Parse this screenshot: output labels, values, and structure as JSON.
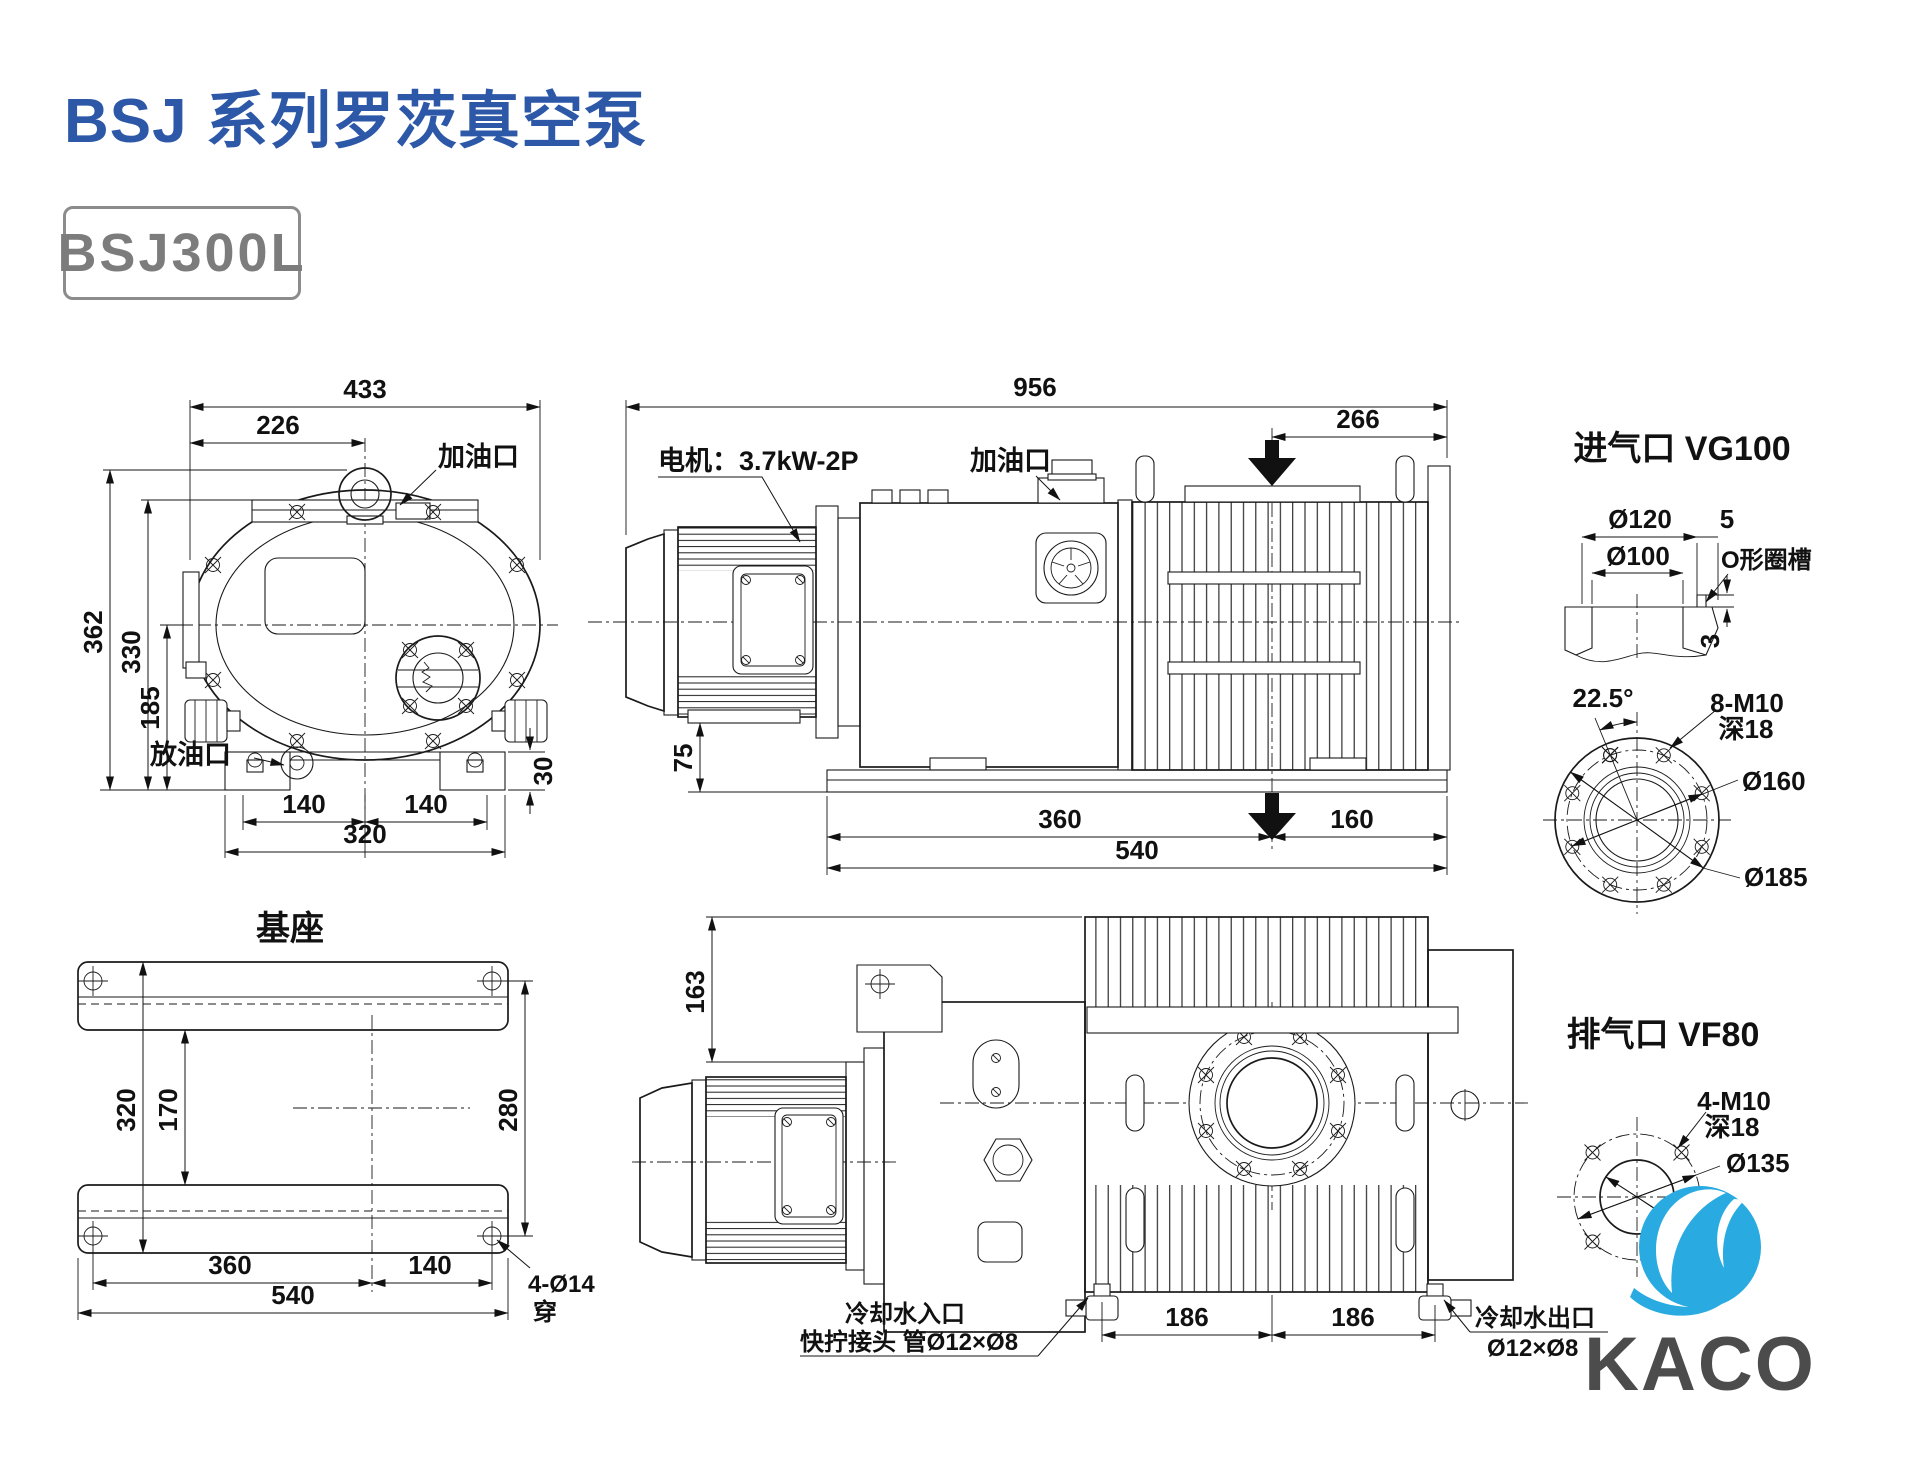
{
  "header": {
    "title": "BSJ 系列罗茨真空泵",
    "model": "BSJ300L"
  },
  "front_view": {
    "oil_fill_label": "加油口",
    "oil_drain_label": "放油口",
    "dim_433": "433",
    "dim_226": "226",
    "dim_362": "362",
    "dim_330": "330",
    "dim_185": "185",
    "dim_140l": "140",
    "dim_140r": "140",
    "dim_320": "320",
    "dim_30": "30"
  },
  "side_view": {
    "motor_label": "电机：3.7kW-2P",
    "oil_fill_label": "加油口",
    "dim_956": "956",
    "dim_266": "266",
    "dim_75": "75",
    "dim_360": "360",
    "dim_160": "160",
    "dim_540": "540"
  },
  "base_view": {
    "title": "基座",
    "dim_320": "320",
    "dim_170": "170",
    "dim_280": "280",
    "dim_360": "360",
    "dim_140": "140",
    "dim_540": "540",
    "hole_note_1": "4-Ø14",
    "hole_note_2": "穿"
  },
  "top_view": {
    "dim_163": "163",
    "dim_186l": "186",
    "dim_186r": "186",
    "coolant_in_1": "冷却水入口",
    "coolant_in_2": "快拧接头 管Ø12×Ø8",
    "coolant_out_1": "冷却水出口",
    "coolant_out_2": "Ø12×Ø8"
  },
  "inlet_detail": {
    "title": "进气口 VG100",
    "dim_d120": "Ø120",
    "dim_5": "5",
    "dim_d100": "Ø100",
    "oring_label": "O形圈槽",
    "dim_3": "3",
    "angle_label": "22.5°",
    "bolt_note_1": "8-M10",
    "bolt_note_2": "深18",
    "dim_d160": "Ø160",
    "dim_d185": "Ø185"
  },
  "outlet_detail": {
    "title": "排气口 VF80",
    "bolt_note_1": "4-M10",
    "bolt_note_2": "深18",
    "dim_d135": "Ø135",
    "dim_d80": "Ø80"
  },
  "logo": {
    "text": "KACO"
  },
  "colors": {
    "title_blue": "#2d58a8",
    "logo_blue": "#29abe2",
    "logo_text_gray": "#4c4c4c",
    "line": "#1a1a1a"
  }
}
